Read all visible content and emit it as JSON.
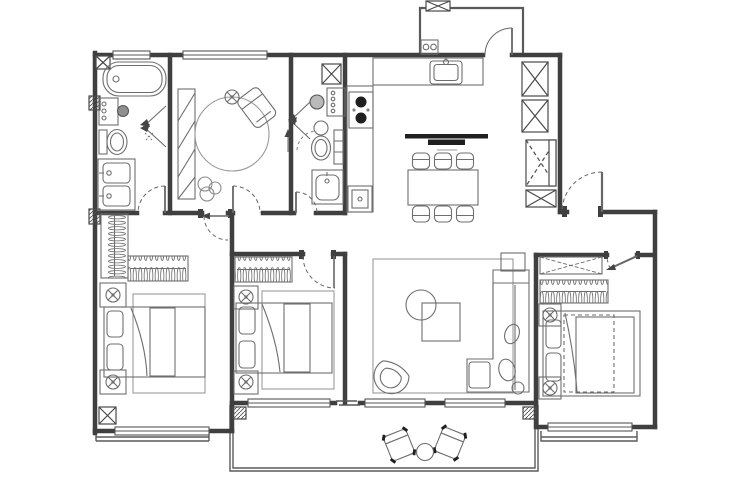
{
  "meta": {
    "artifact": "residential-apartment-floor-plan",
    "canvas": {
      "width": 740,
      "height": 494
    },
    "palette": {
      "background": "#ffffff",
      "wall": "#3f3f3f",
      "thin_wall": "#5a5a5a",
      "furniture": "#6e6e6e",
      "soft_line": "#9a9a9a",
      "dark_fill": "#1f1f1f"
    }
  },
  "rooms": [
    {
      "id": "bathroom-1",
      "furniture": [
        "bathtub",
        "washing-machine",
        "shower-spray",
        "toilet",
        "double-sink-vanity"
      ]
    },
    {
      "id": "study-cloakroom",
      "furniture": [
        "bookshelf",
        "round-rug",
        "lounge-chair",
        "ceiling-light",
        "plant"
      ]
    },
    {
      "id": "bathroom-2",
      "furniture": [
        "washer-drum",
        "vanity-counter",
        "shower-spray",
        "toilet",
        "wash-basin",
        "shelf"
      ]
    },
    {
      "id": "kitchen",
      "furniture": [
        "l-shaped-counter",
        "kitchen-sink",
        "two-burner-cooktop",
        "dishwasher",
        "linear-pendant-light"
      ]
    },
    {
      "id": "dining-area",
      "furniture": [
        "dining-table",
        "dining-chair-x6"
      ]
    },
    {
      "id": "utility-balcony",
      "furniture": [
        "washing-machine"
      ]
    },
    {
      "id": "entry-foyer",
      "furniture": [
        "storage-cabinet-x2",
        "tall-cabinet",
        "shoe-cabinet"
      ]
    },
    {
      "id": "bedroom-1",
      "furniture": [
        "l-shaped-wardrobe",
        "double-bed",
        "nightstand-x2",
        "lamp-x2",
        "area-rug"
      ]
    },
    {
      "id": "bedroom-2",
      "furniture": [
        "wardrobe",
        "double-bed",
        "nightstand-x2",
        "lamp-x2",
        "area-rug"
      ]
    },
    {
      "id": "living-room",
      "furniture": [
        "area-rug",
        "round-coffee-table",
        "square-coffee-table",
        "sectional-sofa",
        "throw-pillows",
        "side-table",
        "fan-armchair"
      ]
    },
    {
      "id": "master-bedroom",
      "furniture": [
        "low-cabinet",
        "wardrobe",
        "double-bed",
        "nightstand-x2",
        "lamp-x2"
      ]
    },
    {
      "id": "balcony",
      "furniture": [
        "outdoor-chair-x2",
        "round-side-table"
      ]
    }
  ],
  "doors": [
    "entry-door",
    "utility-balcony-door",
    "bathroom-1-door",
    "study-door",
    "bathroom-2-door",
    "bedroom-1-door",
    "bedroom-2-door",
    "master-bedroom-door",
    "balcony-sliding-door"
  ],
  "windows": [
    "bathroom-1-window",
    "study-window",
    "bedroom-1-window",
    "bedroom-2-window",
    "living-room-window-left",
    "living-room-window-right",
    "master-bedroom-bay-window"
  ]
}
